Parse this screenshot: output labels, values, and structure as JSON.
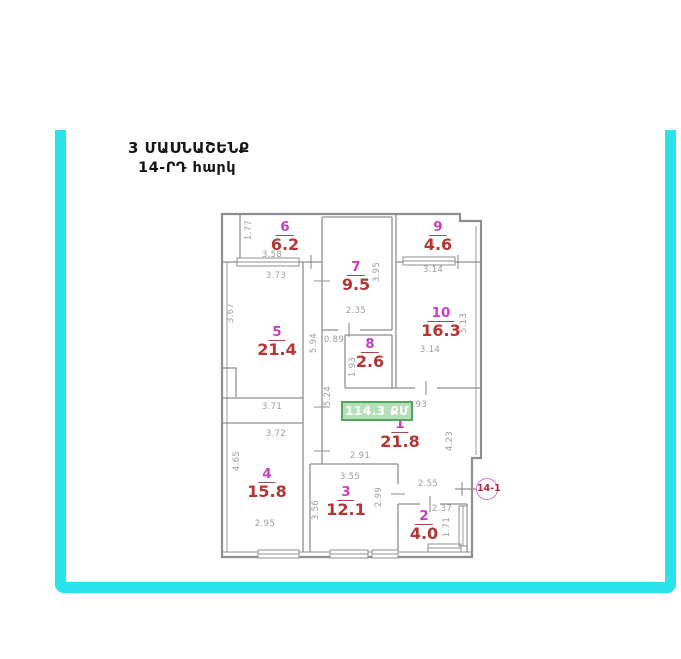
{
  "title": {
    "building": "3 ՄԱՍՆԱՇԵՆՔ",
    "floor": "14-ՐԴ  հարկ"
  },
  "badge": {
    "total_area": "114.3 ՔՄ"
  },
  "marker": {
    "label": "14-1"
  },
  "colors": {
    "frame": "#29e2ec",
    "room_number": "#c43fc4",
    "room_area": "#b53434",
    "dimension": "#9c9c9c",
    "wall": "#8e8e8e",
    "badge_bg": "#b7dfb7",
    "badge_border": "#55a55e",
    "badge_text": "#ffffff",
    "marker_ring": "#d36fd3",
    "marker_text": "#a8323c"
  },
  "rooms": [
    {
      "number": "1",
      "area": "21.8",
      "x": 400,
      "y": 433
    },
    {
      "number": "2",
      "area": "4.0",
      "x": 424,
      "y": 525
    },
    {
      "number": "3",
      "area": "12.1",
      "x": 346,
      "y": 501
    },
    {
      "number": "4",
      "area": "15.8",
      "x": 267,
      "y": 483
    },
    {
      "number": "5",
      "area": "21.4",
      "x": 277,
      "y": 341
    },
    {
      "number": "6",
      "area": "6.2",
      "x": 285,
      "y": 236
    },
    {
      "number": "7",
      "area": "9.5",
      "x": 356,
      "y": 276
    },
    {
      "number": "8",
      "area": "2.6",
      "x": 370,
      "y": 353
    },
    {
      "number": "9",
      "area": "4.6",
      "x": 438,
      "y": 236
    },
    {
      "number": "10",
      "area": "16.3",
      "x": 441,
      "y": 322
    }
  ],
  "dimensions": [
    {
      "text": "1.77",
      "x": 249,
      "y": 230,
      "rot": true
    },
    {
      "text": "3.58",
      "x": 272,
      "y": 255,
      "rot": false
    },
    {
      "text": "3.73",
      "x": 276,
      "y": 276,
      "rot": false
    },
    {
      "text": "3.67",
      "x": 231,
      "y": 313,
      "rot": true
    },
    {
      "text": "5.94",
      "x": 314,
      "y": 343,
      "rot": true
    },
    {
      "text": "2.35",
      "x": 356,
      "y": 311,
      "rot": false
    },
    {
      "text": "3.95",
      "x": 377,
      "y": 272,
      "rot": true
    },
    {
      "text": "3.14",
      "x": 433,
      "y": 270,
      "rot": false
    },
    {
      "text": "5.13",
      "x": 464,
      "y": 323,
      "rot": true
    },
    {
      "text": "3.14",
      "x": 430,
      "y": 350,
      "rot": false
    },
    {
      "text": "0.89",
      "x": 334,
      "y": 340,
      "rot": false
    },
    {
      "text": "1.93",
      "x": 353,
      "y": 367,
      "rot": true
    },
    {
      "text": "5.24",
      "x": 328,
      "y": 396,
      "rot": true
    },
    {
      "text": "3.71",
      "x": 272,
      "y": 407,
      "rot": false
    },
    {
      "text": "4.93",
      "x": 417,
      "y": 405,
      "rot": false
    },
    {
      "text": "3.72",
      "x": 276,
      "y": 434,
      "rot": false
    },
    {
      "text": "2.91",
      "x": 360,
      "y": 456,
      "rot": false
    },
    {
      "text": "4.23",
      "x": 450,
      "y": 441,
      "rot": true
    },
    {
      "text": "4.65",
      "x": 237,
      "y": 461,
      "rot": true
    },
    {
      "text": "2.95",
      "x": 265,
      "y": 524,
      "rot": false
    },
    {
      "text": "3.55",
      "x": 350,
      "y": 477,
      "rot": false
    },
    {
      "text": "3.56",
      "x": 316,
      "y": 510,
      "rot": true
    },
    {
      "text": "2.99",
      "x": 379,
      "y": 497,
      "rot": true
    },
    {
      "text": "2.55",
      "x": 428,
      "y": 484,
      "rot": false
    },
    {
      "text": "2.37",
      "x": 442,
      "y": 509,
      "rot": false
    },
    {
      "text": "1.71",
      "x": 447,
      "y": 527,
      "rot": true
    }
  ]
}
